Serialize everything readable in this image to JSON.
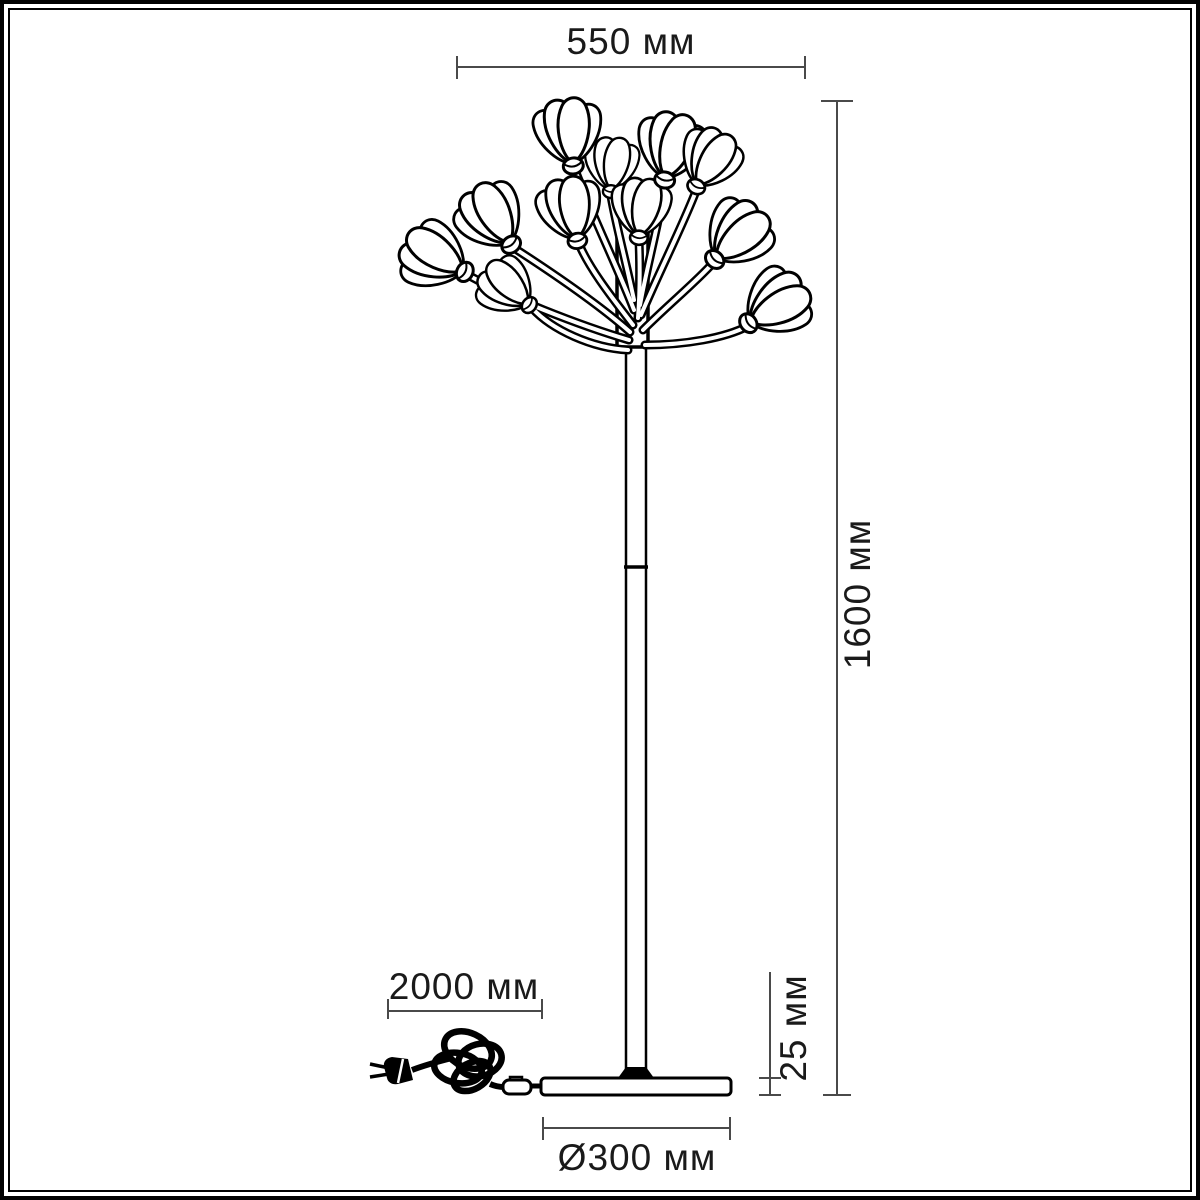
{
  "page": {
    "kind": "product dimensional drawing",
    "subject": "floor lamp with flower-bud shades",
    "background": "#ffffff"
  },
  "colors": {
    "artwork_ink": "#000000",
    "dimension_line": "#4a4a4a",
    "label_text": "#1a1a1a",
    "frame": "#000000"
  },
  "dimensions": {
    "shade_spread": {
      "label": "550 мм",
      "orientation": "horizontal",
      "position": "top"
    },
    "lamp_height": {
      "label": "1600 мм",
      "orientation": "vertical",
      "position": "right"
    },
    "cord_length": {
      "label": "2000 мм",
      "orientation": "horizontal",
      "position": "bottom-left"
    },
    "base_height": {
      "label": "25 мм",
      "orientation": "vertical",
      "position": "bottom-right"
    },
    "base_diameter": {
      "label": "Ø300 мм",
      "orientation": "horizontal",
      "position": "bottom"
    }
  },
  "lamp_parts": {
    "flower_head_count": 11,
    "parts": [
      "flower-cluster",
      "pole",
      "pole-joint",
      "base-plate",
      "power-cord-coil",
      "plug",
      "inline-switch"
    ]
  }
}
